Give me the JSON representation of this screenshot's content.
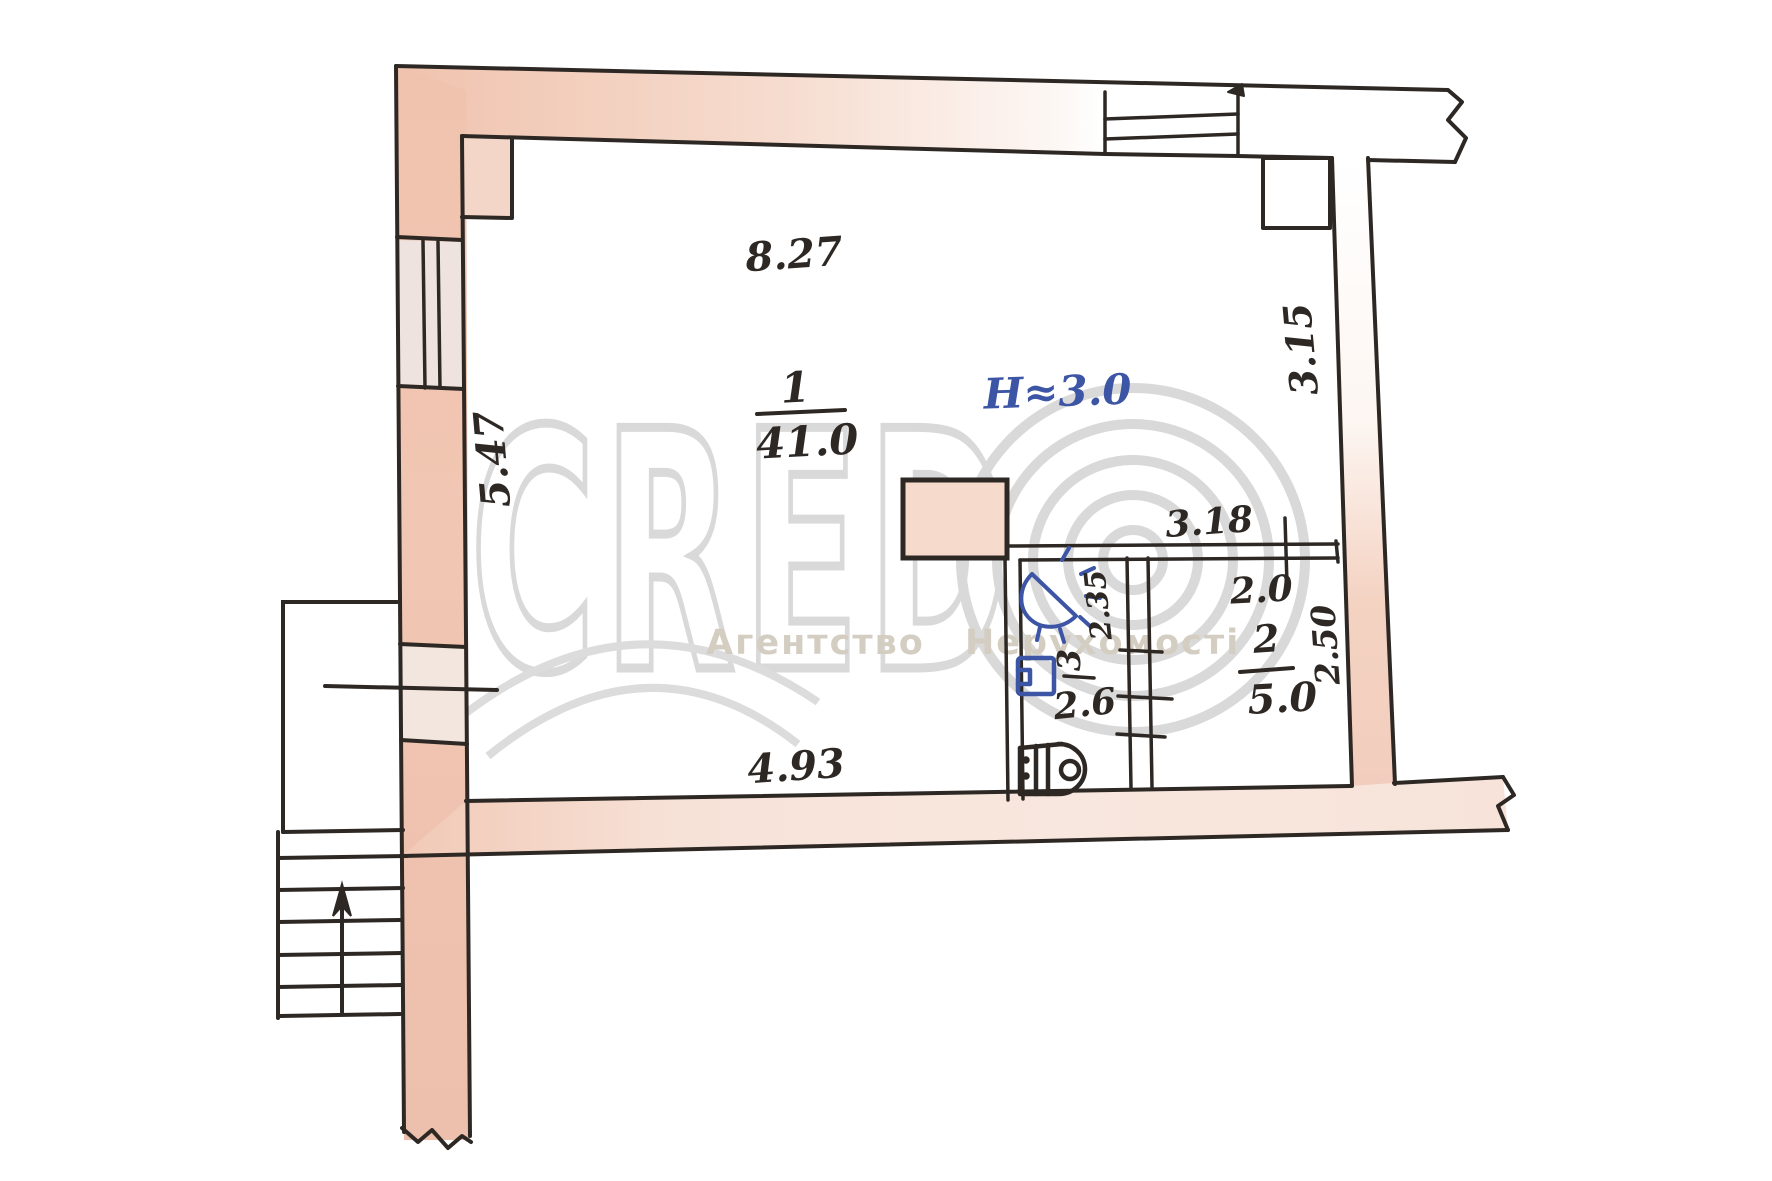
{
  "watermark": {
    "brand_letters": "CRED",
    "caption": "Агентство Нерухомості"
  },
  "rooms": [
    {
      "number": "1",
      "area": "41.0"
    },
    {
      "number": "2",
      "area": "5.0"
    },
    {
      "number": "3",
      "area": ""
    }
  ],
  "height_note": "H≈3.0",
  "dimensions": {
    "top_width": "8.27",
    "left_height": "5.47",
    "right_upper_height": "3.15",
    "partition_length": "3.18",
    "room2_width": "2.0",
    "room2_depth": "2.50",
    "bath_length": "2.35",
    "bath_width": "2.6",
    "bottom_width": "4.93"
  },
  "colors": {
    "wall_pink": "#f0c7b3",
    "wall_pink_light": "#f6e0d6",
    "ink_black": "#2e2824",
    "ink_blue": "#3c55a5",
    "watermark_gray": "#d9d9d9"
  }
}
